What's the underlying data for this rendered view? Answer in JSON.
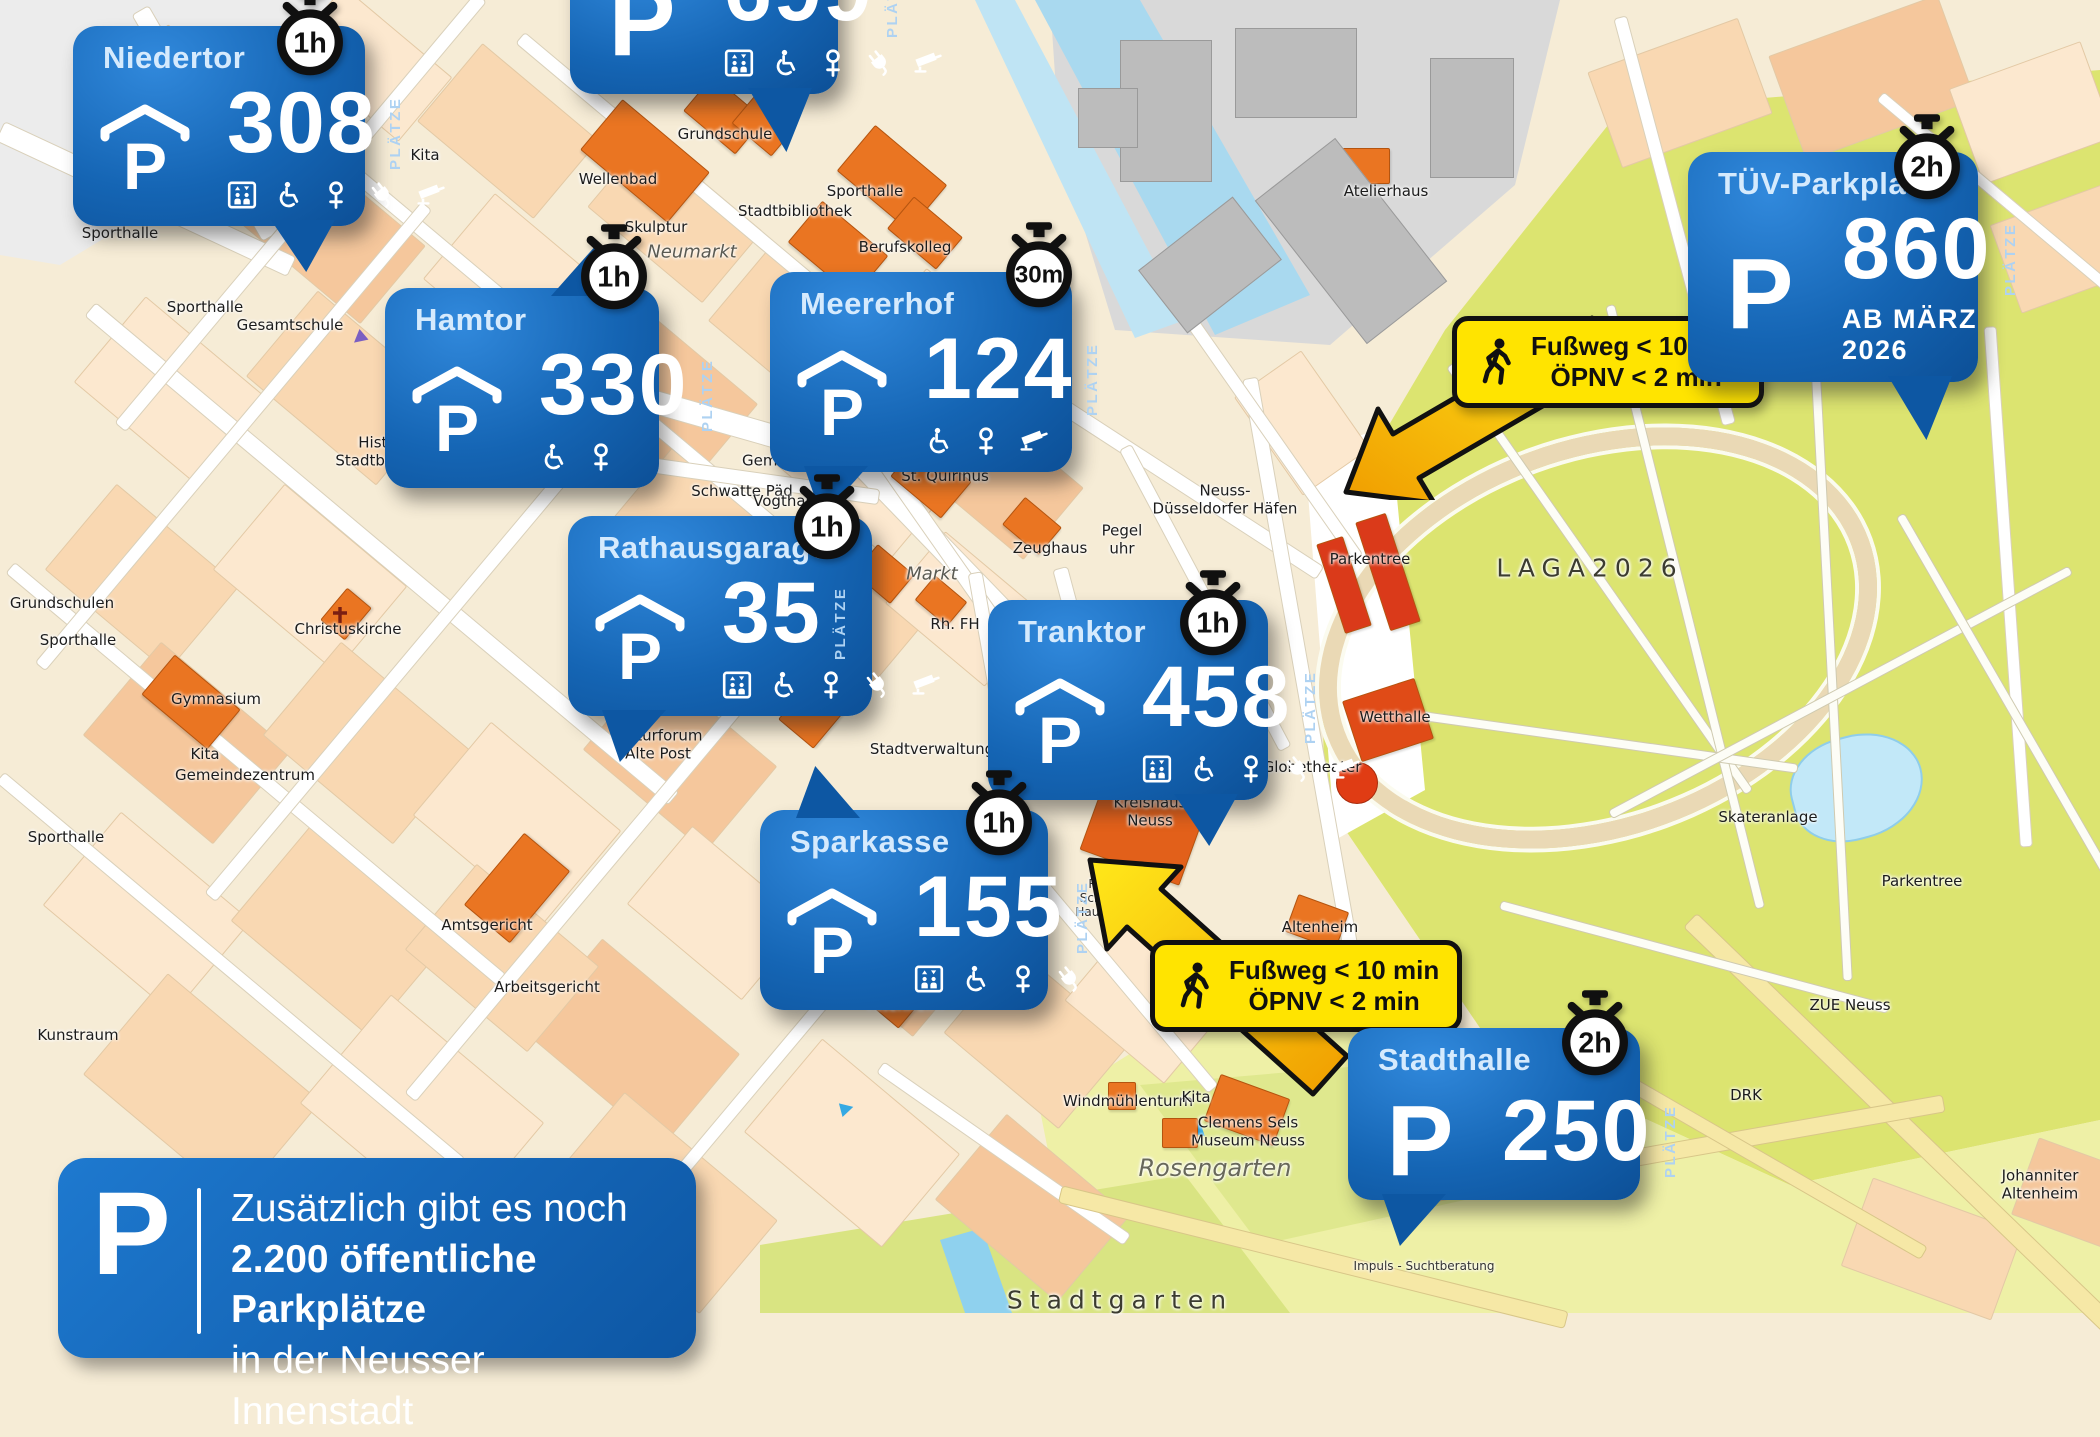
{
  "p_label": "P",
  "colors": {
    "callout_blue": "#1565b4",
    "note_yellow": "#ffe400",
    "park_green": "#dce470",
    "building_orange": "#ea7522",
    "water_blue": "#a9d9ef"
  },
  "info_box": {
    "lines": [
      "Zusätzlich gibt es noch",
      "2.200 öffentliche Parkplätze",
      "in der Neusser Innenstadt"
    ]
  },
  "callouts": [
    {
      "id": "niedertor",
      "title": "Niedertor",
      "count": "308",
      "unit": "PLÄTZE",
      "time_limit": "1h",
      "covered": true,
      "features": [
        "elevator",
        "wheelchair",
        "women",
        "ev-charging",
        "cctv"
      ],
      "x": 73,
      "y": 26,
      "w": 292,
      "tail": "down-right"
    },
    {
      "id": "unnamed-top",
      "title": "",
      "count": "699",
      "unit": "PLÄTZE",
      "time_limit": "",
      "covered": false,
      "features": [
        "elevator",
        "wheelchair",
        "women",
        "ev-charging",
        "cctv"
      ],
      "x": 570,
      "y": -62,
      "w": 268,
      "tail": "down-right-long"
    },
    {
      "id": "hamtor",
      "title": "Hamtor",
      "count": "330",
      "unit": "PLÄTZE",
      "time_limit": "1h",
      "covered": true,
      "features": [
        "wheelchair",
        "women"
      ],
      "x": 385,
      "y": 288,
      "w": 274,
      "tail": "up-right"
    },
    {
      "id": "meererhof",
      "title": "Meererhof",
      "count": "124",
      "unit": "PLÄTZE",
      "time_limit": "30m",
      "covered": true,
      "features": [
        "wheelchair",
        "women",
        "cctv"
      ],
      "x": 770,
      "y": 272,
      "w": 302,
      "tail": "down-left"
    },
    {
      "id": "rathausgarage",
      "title": "Rathausgarage",
      "count": "35",
      "unit": "PLÄTZE",
      "time_limit": "1h",
      "covered": true,
      "features": [
        "elevator",
        "wheelchair",
        "women",
        "ev-charging",
        "cctv"
      ],
      "x": 568,
      "y": 516,
      "w": 304,
      "tail": "down-left"
    },
    {
      "id": "tranktor",
      "title": "Tranktor",
      "count": "458",
      "unit": "PLÄTZE",
      "time_limit": "1h",
      "covered": true,
      "features": [
        "elevator",
        "wheelchair",
        "women",
        "ev-charging",
        "cctv"
      ],
      "x": 988,
      "y": 600,
      "w": 280,
      "tail": "down-right"
    },
    {
      "id": "sparkasse",
      "title": "Sparkasse",
      "count": "155",
      "unit": "PLÄTZE",
      "time_limit": "1h",
      "covered": true,
      "features": [
        "elevator",
        "wheelchair",
        "women",
        "ev-charging"
      ],
      "x": 760,
      "y": 810,
      "w": 288,
      "tail": "up-left"
    },
    {
      "id": "tuev-parkplatz",
      "title": "TÜV-Parkplatz",
      "count": "860",
      "unit": "PLÄTZE",
      "time_limit": "2h",
      "covered": false,
      "note": "AB MÄRZ 2026",
      "features": [],
      "x": 1688,
      "y": 152,
      "w": 290,
      "tail": "down-right-long"
    },
    {
      "id": "stadthalle",
      "title": "Stadthalle",
      "count": "250",
      "unit": "PLÄTZE",
      "time_limit": "2h",
      "covered": false,
      "features": [],
      "x": 1348,
      "y": 1028,
      "w": 292,
      "tail": "down-left"
    }
  ],
  "walk_notes": [
    {
      "lines": [
        "Fußweg < 10 min",
        "ÖPNV < 2 min"
      ],
      "x": 1452,
      "y": 316
    },
    {
      "lines": [
        "Fußweg < 10 min",
        "ÖPNV < 2 min"
      ],
      "x": 1150,
      "y": 940
    }
  ],
  "map_labels": [
    {
      "t": "Gemeindezentrum",
      "x": 225,
      "y": 196
    },
    {
      "t": "Sporthalle",
      "x": 120,
      "y": 234
    },
    {
      "t": "Kita",
      "x": 425,
      "y": 156
    },
    {
      "t": "Wellenbad",
      "x": 618,
      "y": 180
    },
    {
      "t": "Grundschule",
      "x": 725,
      "y": 135
    },
    {
      "t": "Stadtbibliothek",
      "x": 795,
      "y": 212
    },
    {
      "t": "Sporthalle",
      "x": 865,
      "y": 192
    },
    {
      "t": "Berufskolleg",
      "x": 905,
      "y": 248
    },
    {
      "t": "Skulptur",
      "x": 656,
      "y": 228
    },
    {
      "t": "Neumarkt",
      "x": 692,
      "y": 252,
      "s": "it"
    },
    {
      "t": "Sporthalle",
      "x": 205,
      "y": 308
    },
    {
      "t": "Gesamtschule",
      "x": 290,
      "y": 326
    },
    {
      "t": "Historische\nStadtbefestigung",
      "x": 400,
      "y": 452
    },
    {
      "t": "Schwatte Päd",
      "x": 742,
      "y": 492
    },
    {
      "t": "Kita\nGemeindezentrum",
      "x": 812,
      "y": 452
    },
    {
      "t": "Vogthaus",
      "x": 788,
      "y": 502
    },
    {
      "t": "St. Quirinus",
      "x": 945,
      "y": 477
    },
    {
      "t": "Zeughaus",
      "x": 1050,
      "y": 549
    },
    {
      "t": "Markt",
      "x": 932,
      "y": 574,
      "s": "it"
    },
    {
      "t": "Rh. FH",
      "x": 955,
      "y": 625
    },
    {
      "t": "Neuss-\nDüsseldorfer Häfen",
      "x": 1225,
      "y": 500
    },
    {
      "t": "Pegel\nuhr",
      "x": 1122,
      "y": 540
    },
    {
      "t": "Atelierhaus",
      "x": 1386,
      "y": 192
    },
    {
      "t": "Parkentree",
      "x": 1370,
      "y": 560
    },
    {
      "t": "LAGA2026",
      "x": 1590,
      "y": 568,
      "s": "big"
    },
    {
      "t": "Wetthalle",
      "x": 1395,
      "y": 718
    },
    {
      "t": "Globetheater",
      "x": 1312,
      "y": 768
    },
    {
      "t": "Skateranlage",
      "x": 1768,
      "y": 818
    },
    {
      "t": "Parkentree",
      "x": 1922,
      "y": 882
    },
    {
      "t": "ZUE Neuss",
      "x": 1850,
      "y": 1006
    },
    {
      "t": "Kunstraum",
      "x": 78,
      "y": 1036
    },
    {
      "t": "Amtsgericht",
      "x": 487,
      "y": 926
    },
    {
      "t": "Arbeitsgericht",
      "x": 547,
      "y": 988
    },
    {
      "t": "Gymnasium",
      "x": 216,
      "y": 700
    },
    {
      "t": "Kita",
      "x": 205,
      "y": 755
    },
    {
      "t": "Gemeindezentrum",
      "x": 245,
      "y": 776
    },
    {
      "t": "Sporthalle",
      "x": 66,
      "y": 838
    },
    {
      "t": "Grundschulen",
      "x": 62,
      "y": 604
    },
    {
      "t": "Sporthalle",
      "x": 78,
      "y": 641
    },
    {
      "t": "Christuskirche",
      "x": 348,
      "y": 630
    },
    {
      "t": "Kulturforum\nAlte Post",
      "x": 658,
      "y": 745
    },
    {
      "t": "Stadtverwaltung",
      "x": 932,
      "y": 750
    },
    {
      "t": "Landestheater",
      "x": 1140,
      "y": 764
    },
    {
      "t": "Kreishaus\nNeuss",
      "x": 1150,
      "y": 812
    },
    {
      "t": "Altenheim",
      "x": 906,
      "y": 1006
    },
    {
      "t": "Altenheim",
      "x": 1320,
      "y": 928
    },
    {
      "t": "Windmühlenturm",
      "x": 1128,
      "y": 1102
    },
    {
      "t": "Kita",
      "x": 1196,
      "y": 1098
    },
    {
      "t": "Clemens Sels\nMuseum Neuss",
      "x": 1248,
      "y": 1132
    },
    {
      "t": "Rosengarten",
      "x": 1215,
      "y": 1168,
      "s": "it-lg"
    },
    {
      "t": "Stadtgarten",
      "x": 1120,
      "y": 1300,
      "s": "big"
    },
    {
      "t": "Impuls - Suchtberatung",
      "x": 1424,
      "y": 1266,
      "s": "sm"
    },
    {
      "t": "DRK",
      "x": 1746,
      "y": 1096
    },
    {
      "t": "Johanniter\nAltenheim",
      "x": 2040,
      "y": 1185
    },
    {
      "t": "Rhe\nSchütz\nHaus Ro",
      "x": 1100,
      "y": 898,
      "s": "sm"
    },
    {
      "t": "pädag.\nK.\nObe",
      "x": 1308,
      "y": 1058,
      "s": "sm"
    }
  ]
}
